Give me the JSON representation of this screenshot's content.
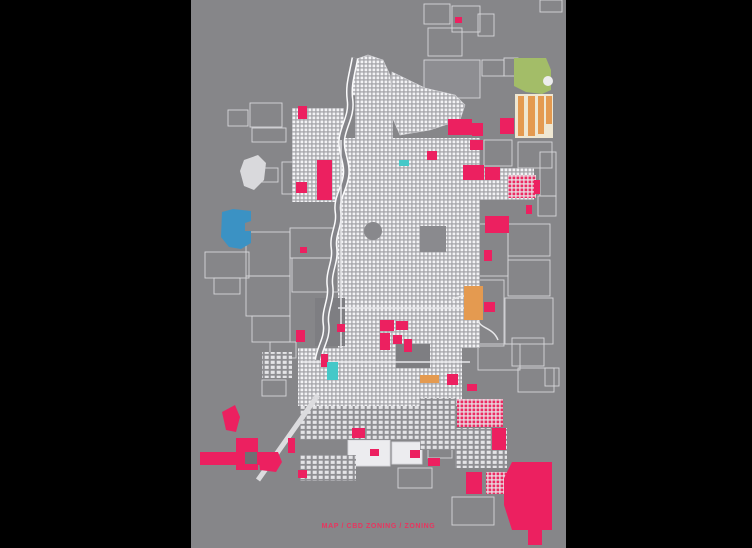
{
  "caption": {
    "text": "MAP / CBD ZONING / ZONING",
    "color": "#e8355f"
  },
  "colors": {
    "page_bg": "#000000",
    "plate": "#868689",
    "pink": "#ec2060",
    "blue": "#3b92c4",
    "teal": "#45c8c8",
    "orange": "#e49a50",
    "cream": "#efe7d2",
    "green": "#a3bd68",
    "outline": "#d6d6da",
    "river_edge": "#fbfbfc",
    "river_core": "#85858a",
    "road": "#dcdcdf"
  },
  "plate": {
    "x": 191,
    "y": 0,
    "w": 375,
    "h": 548
  },
  "map": {
    "outlined_blocks": [
      {
        "x": 228,
        "y": 110,
        "w": 20,
        "h": 16
      },
      {
        "x": 250,
        "y": 103,
        "w": 32,
        "h": 24
      },
      {
        "x": 252,
        "y": 128,
        "w": 34,
        "h": 14
      },
      {
        "x": 258,
        "y": 168,
        "w": 20,
        "h": 14
      },
      {
        "x": 282,
        "y": 162,
        "w": 22,
        "h": 32
      },
      {
        "x": 246,
        "y": 232,
        "w": 44,
        "h": 44
      },
      {
        "x": 290,
        "y": 228,
        "w": 48,
        "h": 30
      },
      {
        "x": 292,
        "y": 258,
        "w": 46,
        "h": 34
      },
      {
        "x": 246,
        "y": 276,
        "w": 44,
        "h": 40
      },
      {
        "x": 252,
        "y": 316,
        "w": 38,
        "h": 26
      },
      {
        "x": 270,
        "y": 342,
        "w": 26,
        "h": 16
      },
      {
        "x": 205,
        "y": 252,
        "w": 44,
        "h": 26
      },
      {
        "x": 214,
        "y": 278,
        "w": 26,
        "h": 16
      },
      {
        "x": 424,
        "y": 4,
        "w": 26,
        "h": 20
      },
      {
        "x": 452,
        "y": 6,
        "w": 28,
        "h": 26
      },
      {
        "x": 478,
        "y": 14,
        "w": 16,
        "h": 22
      },
      {
        "x": 428,
        "y": 28,
        "w": 34,
        "h": 28
      },
      {
        "x": 424,
        "y": 60,
        "w": 56,
        "h": 38,
        "fill": "#8e8e92"
      },
      {
        "x": 482,
        "y": 60,
        "w": 22,
        "h": 16
      },
      {
        "x": 504,
        "y": 58,
        "w": 14,
        "h": 18
      },
      {
        "x": 540,
        "y": 0,
        "w": 22,
        "h": 12
      },
      {
        "x": 484,
        "y": 140,
        "w": 28,
        "h": 26
      },
      {
        "x": 518,
        "y": 142,
        "w": 34,
        "h": 26
      },
      {
        "x": 540,
        "y": 152,
        "w": 16,
        "h": 44
      },
      {
        "x": 538,
        "y": 196,
        "w": 18,
        "h": 20
      },
      {
        "x": 508,
        "y": 224,
        "w": 42,
        "h": 32
      },
      {
        "x": 508,
        "y": 260,
        "w": 42,
        "h": 36
      },
      {
        "x": 452,
        "y": 224,
        "w": 56,
        "h": 52
      },
      {
        "x": 452,
        "y": 280,
        "w": 52,
        "h": 66
      },
      {
        "x": 505,
        "y": 298,
        "w": 48,
        "h": 46
      },
      {
        "x": 478,
        "y": 344,
        "w": 42,
        "h": 26
      },
      {
        "x": 512,
        "y": 338,
        "w": 32,
        "h": 28
      },
      {
        "x": 518,
        "y": 368,
        "w": 36,
        "h": 24
      },
      {
        "x": 545,
        "y": 368,
        "w": 14,
        "h": 18
      },
      {
        "x": 452,
        "y": 497,
        "w": 42,
        "h": 28
      },
      {
        "x": 262,
        "y": 380,
        "w": 24,
        "h": 16
      },
      {
        "x": 318,
        "y": 418,
        "w": 20,
        "h": 14
      },
      {
        "x": 398,
        "y": 468,
        "w": 34,
        "h": 20
      },
      {
        "x": 428,
        "y": 440,
        "w": 24,
        "h": 18
      },
      {
        "x": 348,
        "y": 440,
        "w": 42,
        "h": 26,
        "fill": "#ececef"
      },
      {
        "x": 392,
        "y": 442,
        "w": 30,
        "h": 22,
        "fill": "#ececef"
      }
    ],
    "fabric_polys": [
      {
        "points": "352,95 354,60 368,55 383,60 390,75 392,95",
        "pattern": "dense"
      },
      {
        "points": "392,72 425,88 455,95 465,105 460,120 430,130 400,135 390,112",
        "pattern": "dense"
      }
    ],
    "fabric": [
      {
        "x": 355,
        "y": 93,
        "w": 38,
        "h": 48,
        "pattern": "dense"
      },
      {
        "x": 338,
        "y": 138,
        "w": 142,
        "h": 210,
        "pattern": "dense"
      },
      {
        "x": 292,
        "y": 140,
        "w": 46,
        "h": 62,
        "pattern": "dense"
      },
      {
        "x": 292,
        "y": 108,
        "w": 52,
        "h": 36,
        "pattern": "dense"
      },
      {
        "x": 480,
        "y": 168,
        "w": 54,
        "h": 32,
        "pattern": "dense"
      },
      {
        "x": 298,
        "y": 348,
        "w": 164,
        "h": 58,
        "pattern": "dense"
      },
      {
        "x": 300,
        "y": 406,
        "w": 144,
        "h": 34,
        "pattern": "sparse"
      },
      {
        "x": 420,
        "y": 398,
        "w": 36,
        "h": 52,
        "pattern": "sparse"
      },
      {
        "x": 455,
        "y": 428,
        "w": 52,
        "h": 40,
        "pattern": "sparse"
      },
      {
        "x": 300,
        "y": 455,
        "w": 56,
        "h": 26,
        "pattern": "sparse"
      },
      {
        "x": 262,
        "y": 352,
        "w": 30,
        "h": 26,
        "pattern": "sparse"
      }
    ],
    "pink_grids": [
      {
        "x": 457,
        "y": 399,
        "w": 46,
        "h": 28
      },
      {
        "x": 486,
        "y": 472,
        "w": 28,
        "h": 22
      },
      {
        "x": 508,
        "y": 175,
        "w": 28,
        "h": 23
      }
    ],
    "gray_blocks": [
      {
        "x": 315,
        "y": 298,
        "w": 30,
        "h": 48,
        "fill": "#7e7e82"
      },
      {
        "x": 420,
        "y": 226,
        "w": 26,
        "h": 26,
        "fill": "#8a8a8e"
      },
      {
        "x": 364,
        "y": 222,
        "w": 18,
        "h": 18,
        "rx": 9,
        "fill": "#88888c"
      },
      {
        "x": 396,
        "y": 344,
        "w": 34,
        "h": 24,
        "fill": "#7e7e82"
      },
      {
        "x": 515,
        "y": 94,
        "w": 38,
        "h": 44,
        "fill": "#efe7d2"
      }
    ],
    "gray_polys": [
      {
        "points": "244,160 258,155 266,163 264,180 254,190 244,186 240,171",
        "fill": "#d9d9dc"
      }
    ],
    "river": "M355,58 C352,75 348,85 350,100 C352,115 344,125 342,138 C340,152 348,162 346,176 C344,190 336,198 338,212 C340,226 332,234 334,248 C336,262 328,272 330,286 C332,300 324,310 326,324 C328,338 320,346 318,360",
    "roads": [
      {
        "d": "M318,395 L258,480",
        "w": 5,
        "c": "#dcdcdf"
      },
      {
        "d": "M338,308 L482,308",
        "w": 1.5,
        "c": "#e6e6e9"
      },
      {
        "d": "M302,362 L470,362",
        "w": 1.5,
        "c": "#e6e6e9"
      },
      {
        "d": "M341,140 L341,348",
        "w": 1.5,
        "c": "#e6e6e9"
      },
      {
        "d": "M452,300 C470,290 480,300 478,315 C476,330 492,325 498,340",
        "w": 1.5,
        "c": "#e8e8ea"
      }
    ],
    "zones": [
      {
        "kind": "pink",
        "x": 298,
        "y": 106,
        "w": 9,
        "h": 13
      },
      {
        "kind": "pink",
        "x": 317,
        "y": 160,
        "w": 15,
        "h": 40
      },
      {
        "kind": "pink",
        "x": 296,
        "y": 182,
        "w": 11,
        "h": 11
      },
      {
        "kind": "pink",
        "x": 448,
        "y": 119,
        "w": 24,
        "h": 16
      },
      {
        "kind": "pink",
        "x": 472,
        "y": 123,
        "w": 11,
        "h": 13
      },
      {
        "kind": "pink",
        "x": 470,
        "y": 140,
        "w": 13,
        "h": 10
      },
      {
        "kind": "pink",
        "x": 427,
        "y": 151,
        "w": 10,
        "h": 9
      },
      {
        "kind": "pink",
        "x": 463,
        "y": 165,
        "w": 21,
        "h": 15
      },
      {
        "kind": "pink",
        "x": 485,
        "y": 167,
        "w": 15,
        "h": 13
      },
      {
        "kind": "pink",
        "x": 485,
        "y": 216,
        "w": 24,
        "h": 17
      },
      {
        "kind": "pink",
        "x": 484,
        "y": 250,
        "w": 8,
        "h": 11
      },
      {
        "kind": "pink",
        "x": 466,
        "y": 472,
        "w": 16,
        "h": 22
      },
      {
        "kind": "pink",
        "x": 380,
        "y": 320,
        "w": 14,
        "h": 11
      },
      {
        "kind": "pink",
        "x": 396,
        "y": 321,
        "w": 12,
        "h": 9
      },
      {
        "kind": "pink",
        "x": 380,
        "y": 333,
        "w": 10,
        "h": 17
      },
      {
        "kind": "pink",
        "x": 393,
        "y": 335,
        "w": 9,
        "h": 9
      },
      {
        "kind": "pink",
        "x": 404,
        "y": 339,
        "w": 8,
        "h": 13
      },
      {
        "kind": "pink",
        "x": 447,
        "y": 374,
        "w": 11,
        "h": 11
      },
      {
        "kind": "pink",
        "x": 484,
        "y": 302,
        "w": 11,
        "h": 10
      },
      {
        "kind": "pink",
        "x": 296,
        "y": 330,
        "w": 9,
        "h": 12
      },
      {
        "kind": "pink",
        "x": 321,
        "y": 354,
        "w": 7,
        "h": 13
      },
      {
        "kind": "pink",
        "x": 337,
        "y": 324,
        "w": 8,
        "h": 8
      },
      {
        "kind": "pink",
        "x": 300,
        "y": 247,
        "w": 7,
        "h": 6
      },
      {
        "kind": "pink",
        "x": 200,
        "y": 452,
        "w": 68,
        "h": 13
      },
      {
        "kind": "pink",
        "x": 236,
        "y": 438,
        "w": 22,
        "h": 32
      },
      {
        "kind": "pink",
        "x": 288,
        "y": 438,
        "w": 7,
        "h": 15
      },
      {
        "kind": "pink",
        "x": 352,
        "y": 428,
        "w": 13,
        "h": 10
      },
      {
        "kind": "pink",
        "x": 370,
        "y": 449,
        "w": 9,
        "h": 7
      },
      {
        "kind": "pink",
        "x": 410,
        "y": 450,
        "w": 10,
        "h": 8
      },
      {
        "kind": "pink",
        "x": 428,
        "y": 458,
        "w": 12,
        "h": 8
      },
      {
        "kind": "pink",
        "x": 492,
        "y": 428,
        "w": 14,
        "h": 22
      },
      {
        "kind": "pink",
        "x": 455,
        "y": 17,
        "w": 7,
        "h": 6
      },
      {
        "kind": "pink",
        "x": 500,
        "y": 118,
        "w": 14,
        "h": 16
      },
      {
        "kind": "pink",
        "x": 526,
        "y": 205,
        "w": 6,
        "h": 9
      },
      {
        "kind": "pink",
        "x": 298,
        "y": 470,
        "w": 9,
        "h": 8
      },
      {
        "kind": "pink",
        "x": 534,
        "y": 180,
        "w": 6,
        "h": 14
      },
      {
        "kind": "pink",
        "x": 467,
        "y": 384,
        "w": 10,
        "h": 7
      },
      {
        "kind": "teal",
        "x": 399,
        "y": 160,
        "w": 10,
        "h": 6
      },
      {
        "kind": "teal",
        "x": 327,
        "y": 362,
        "w": 11,
        "h": 18
      },
      {
        "kind": "orange",
        "x": 464,
        "y": 286,
        "w": 19,
        "h": 34
      },
      {
        "kind": "orange",
        "x": 420,
        "y": 375,
        "w": 19,
        "h": 8
      },
      {
        "kind": "orange",
        "x": 518,
        "y": 96,
        "w": 6,
        "h": 40
      },
      {
        "kind": "orange",
        "x": 528,
        "y": 96,
        "w": 7,
        "h": 40
      },
      {
        "kind": "orange",
        "x": 538,
        "y": 96,
        "w": 6,
        "h": 38
      },
      {
        "kind": "orange",
        "x": 546,
        "y": 96,
        "w": 6,
        "h": 28
      }
    ],
    "zone_polys": [
      {
        "kind": "pink",
        "points": "222,412 235,405 240,417 236,432 226,430"
      },
      {
        "kind": "pink",
        "points": "258,452 278,452 282,462 276,472 260,470"
      },
      {
        "kind": "pink",
        "points": "512,462 552,462 552,530 542,530 542,545 528,545 528,530 512,530 504,505 504,478"
      },
      {
        "kind": "blue",
        "points": "222,212 233,209 251,211 251,221 245,223 245,231 251,231 251,243 241,249 229,247 221,237"
      },
      {
        "kind": "green",
        "points": "514,58 546,58 551,70 551,90 542,94 526,92 514,86"
      }
    ],
    "overlays": [
      {
        "x": 245,
        "y": 452,
        "w": 12,
        "h": 12,
        "fill": "#6f6f73"
      },
      {
        "x": 543,
        "y": 76,
        "w": 10,
        "h": 10,
        "rx": 5,
        "fill": "#ededee"
      }
    ]
  }
}
